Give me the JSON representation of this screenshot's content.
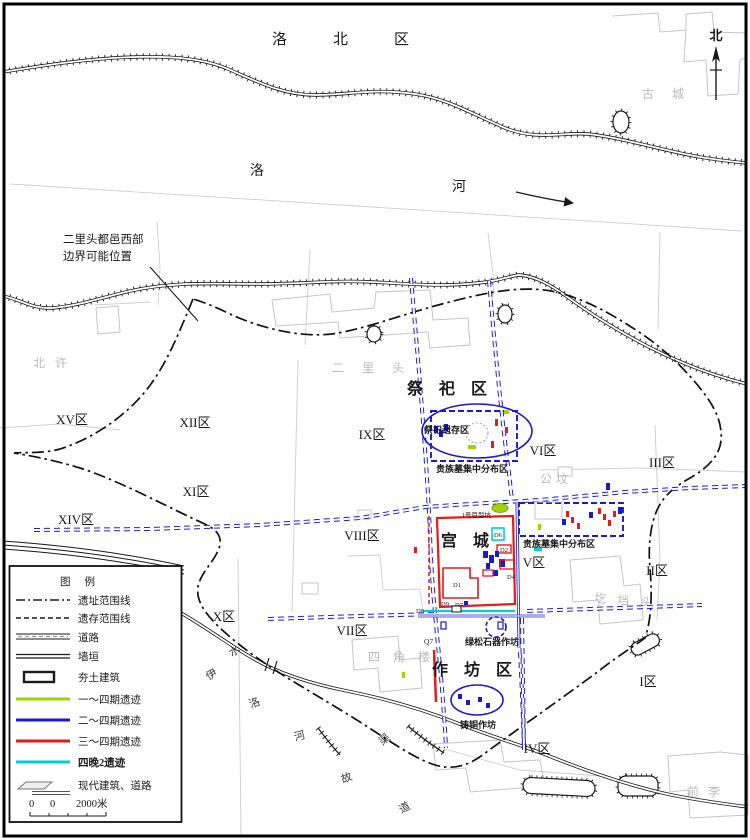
{
  "labels": {
    "north_region": "洛北区",
    "luo_char": "洛",
    "he_char": "河",
    "compass": "北",
    "note_line1": "二里头都邑西部",
    "note_line2": "边界可能位置",
    "villages": {
      "beixu": "北许",
      "erlitou": "二里头",
      "gucheng": "古城",
      "gongfen": "公坟",
      "gedangtou": "圪垱头",
      "sijiaolou": "四角楼",
      "qianli": "前李"
    },
    "river_chars": [
      "水",
      "伊",
      "洛",
      "河",
      "渠",
      "故",
      "道"
    ],
    "zones": {
      "xv": "XV区",
      "xii": "XII区",
      "ix": "IX区",
      "vi": "VI区",
      "iii": "III区",
      "xi": "XI区",
      "xiv": "XIV区",
      "viii": "VIII区",
      "v": "V区",
      "ii": "II区",
      "x": "X区",
      "vii": "VII区",
      "i": "I区",
      "iv": "IV区"
    },
    "areas": {
      "sacrificial": "祭祀区",
      "sacrificial_remains": "祭祀遗存区",
      "noble_tombs_1": "贵族墓集中分布区",
      "noble_tombs_2": "贵族墓集中分布区",
      "palace": "宫城",
      "workshop": "作坊区",
      "turquoise": "绿松石器作坊",
      "bronze": "铸铜作坊",
      "giant_pit": "1号巨型坑"
    },
    "features": {
      "d1": "D1",
      "d2": "D2",
      "d4": "D4",
      "d6": "D6",
      "d7": "D7",
      "d8": "D8",
      "d9": "D9",
      "q7": "Q7"
    }
  },
  "legend": {
    "title": "图例",
    "items": [
      {
        "label": "遗址范围线",
        "symbol": "dash-dot-line"
      },
      {
        "label": "遗存范围线",
        "symbol": "dashed-line"
      },
      {
        "label": "道路",
        "symbol": "road-double-line"
      },
      {
        "label": "墙垣",
        "symbol": "wall-double-line"
      },
      {
        "label": "夯土建筑",
        "symbol": "rammed-earth-rect"
      },
      {
        "label": "一～四期遗迹",
        "symbol": "line",
        "color": "#9ed400"
      },
      {
        "label": "二～四期遗迹",
        "symbol": "line",
        "color": "#1a1acd"
      },
      {
        "label": "三～四期遗迹",
        "symbol": "line",
        "color": "#e31b1b"
      },
      {
        "label": "四晚2遗迹",
        "symbol": "line",
        "color": "#00d0d0"
      },
      {
        "label": "现代建筑、道路",
        "symbol": "modern-building-road"
      }
    ],
    "scale": {
      "tick1": "0",
      "tick2": "0",
      "end_label": "2000米"
    }
  },
  "colors": {
    "phase1_4": "#9ed400",
    "phase2_4": "#1a1acd",
    "phase3_4": "#e31b1b",
    "phase4_late2": "#00d0d0",
    "ancient_road": "#2020cc",
    "cadastral": "#cdcdcd",
    "village_text": "#b9b9b9",
    "ink": "#1a1a1a",
    "background": "#ffffff"
  }
}
